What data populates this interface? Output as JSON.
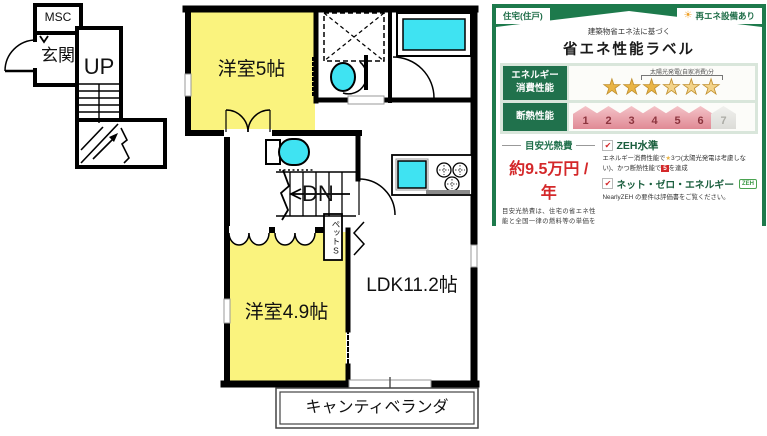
{
  "floor_plan": {
    "labels": {
      "msc": "MSC",
      "entrance": "玄関",
      "up": "UP",
      "dn": "DN",
      "room_a": "洋室5帖",
      "room_b": "洋室4.9帖",
      "ldk": "LDK11.2帖",
      "pet_storage": "ペットS",
      "veranda": "キャンティベランダ"
    },
    "colors": {
      "room_fill": "#FAF37E",
      "fixture_fill": "#3FE3F2"
    }
  },
  "energy_label": {
    "housing_type": "住宅(住戸)",
    "renewable": "再エネ設備あり",
    "law_note": "建築物省エネ法に基づく",
    "title": "省エネ性能ラベル",
    "energy_row": {
      "line1": "エネルギー",
      "line2": "消費性能"
    },
    "solar_note": "太陽光発電(自家消費)分",
    "stars": [
      "★",
      "★",
      "★",
      "★",
      "★",
      "★"
    ],
    "stars_filled": 3,
    "stars_solar": 3,
    "insulation_label": "断熱性能",
    "insulation_levels": [
      "1",
      "2",
      "3",
      "4",
      "5",
      "6",
      "7"
    ],
    "insulation_achieved": 6,
    "cost_heading": "目安光熱費",
    "cost_value": "約9.5万円 / 年",
    "cost_note": "目安光熱費は、住宅の省エネ性能と全国一律の燃料等の単価を用いて算出したものです。実際の光熱費は、使用条件や設備、契約会社・方法などにより異なります。",
    "zeh_level": "ZEH水準",
    "zeh1": "エネルギー消費性能で",
    "zeh_star": "★",
    "zeh2": "3つ(太陽光発電は考慮しない)、かつ断熱性能で",
    "zeh_num": "5",
    "zeh3": "を達成",
    "nze_label": "ネット・ゼロ・エネルギー",
    "zeh_badge": "ZEH",
    "nearly_note": "NearlyZEH の要件は評価書をご覧ください。",
    "evaluator": "第三者評価",
    "bels": "BELS",
    "building": "サンボナール M 棟 202号室",
    "eval_date": "評価日 2024年10月3日",
    "eval_code": "a5572567-743e-4744",
    "colors": {
      "green": "#1D7A4C",
      "dark_green": "#0D5434",
      "panel": "#D9E6DB",
      "star_gold": "#E9B445",
      "pink": "#E08A95",
      "red": "#D4282A"
    }
  },
  "icons": {
    "sun": "☀",
    "check": "✔"
  }
}
